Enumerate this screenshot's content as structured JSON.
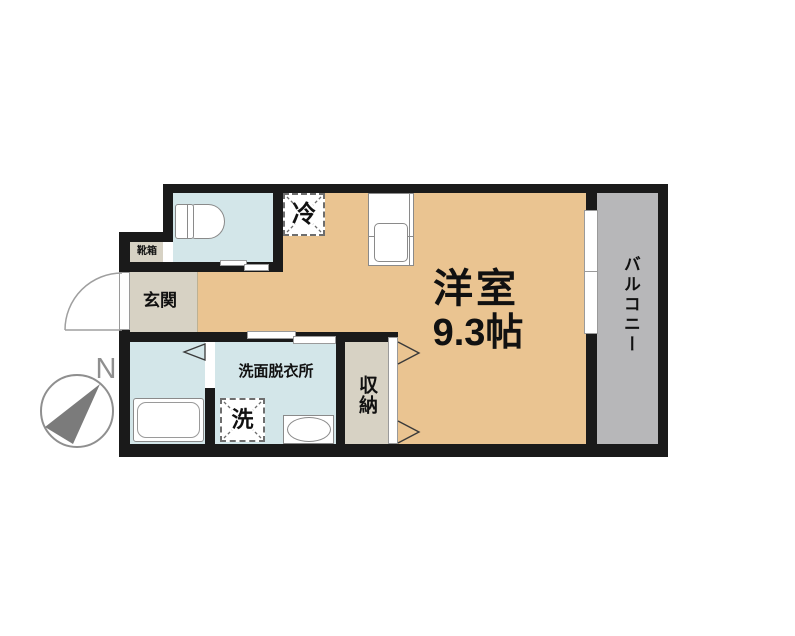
{
  "floorplan": {
    "main_room": {
      "label": "洋室",
      "size": "9.3帖"
    },
    "balcony": {
      "label": "バルコニー"
    },
    "entrance": {
      "label": "玄関"
    },
    "shoe_box": {
      "label": "靴箱"
    },
    "toilet": {
      "label": ""
    },
    "washroom": {
      "label": "洗面脱衣所"
    },
    "washing_machine": {
      "label": "洗"
    },
    "storage": {
      "label": "収納"
    },
    "refrigerator": {
      "label": "冷"
    },
    "compass": {
      "north_label": "N"
    },
    "colors": {
      "wall": "#1a1a1a",
      "main_room": "#eac491",
      "wet_area": "#d3e6e9",
      "entrance_area": "#d7d2c4",
      "balcony": "#b7b7b9"
    }
  }
}
